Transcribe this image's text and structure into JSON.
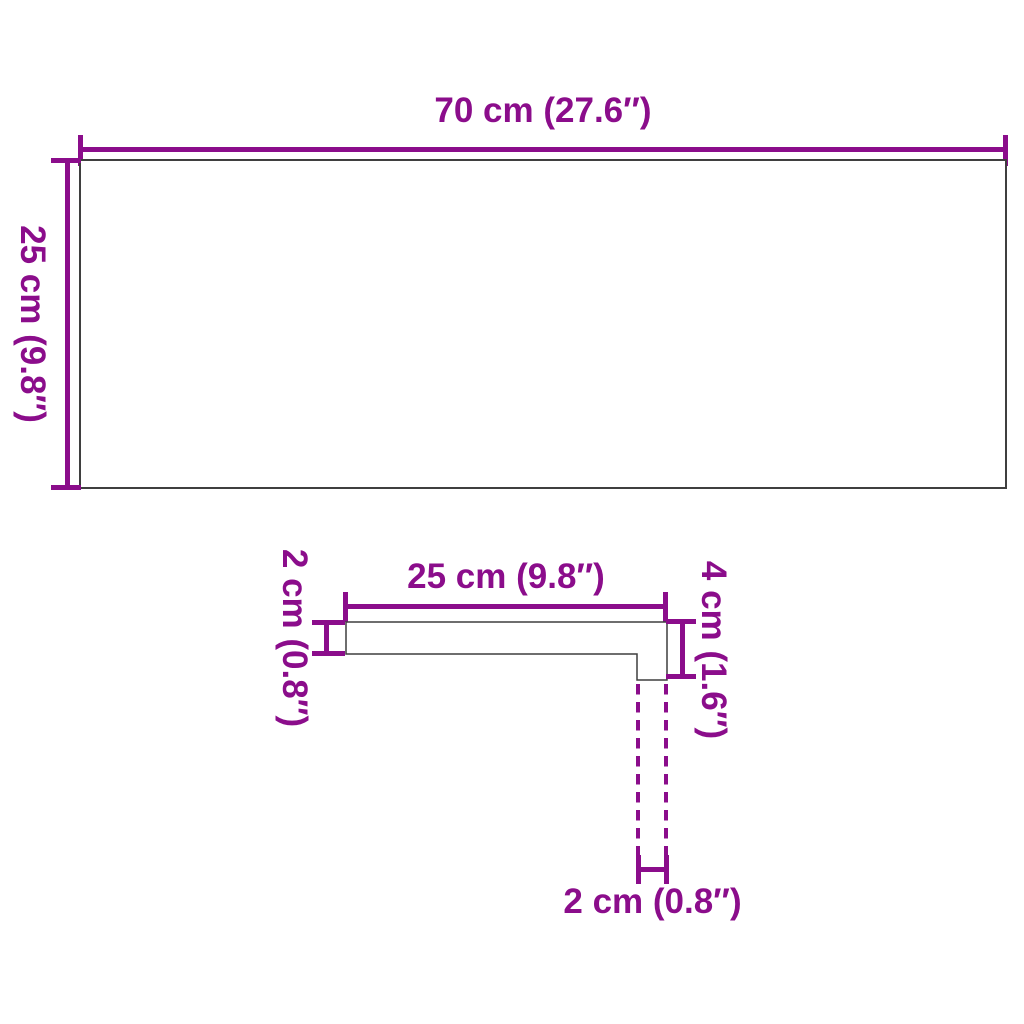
{
  "colors": {
    "accent": "#8B0D8B",
    "outline": "#3F3F3F",
    "background": "#FFFFFF"
  },
  "top_view": {
    "width_label": "70 cm (27.6″)",
    "height_label": "25 cm (9.8″)"
  },
  "profile_view": {
    "width_label": "25 cm (9.8″)",
    "thickness_label": "2 cm (0.8″)",
    "nose_height_label": "4 cm (1.6″)",
    "nose_thickness_label": "2 cm (0.8″)"
  }
}
